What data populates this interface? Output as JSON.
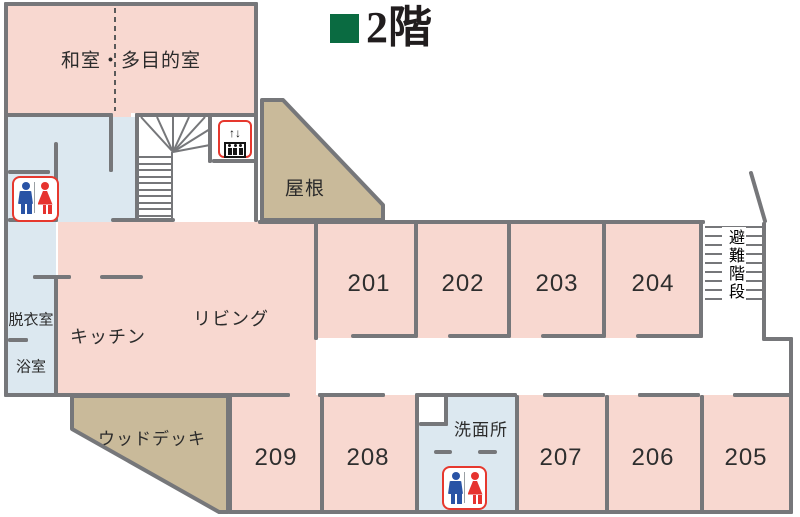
{
  "title": {
    "text": "2階"
  },
  "floor_labels": {
    "washitsu": "和室・多目的室",
    "roof": "屋根",
    "living": "リビング",
    "kitchen": "キッチン",
    "dressing_room": "脱衣室",
    "bathroom": "浴室",
    "wood_deck": "ウッドデッキ",
    "washroom": "洗面所",
    "emergency_stairs": "避難階段"
  },
  "rooms_top": [
    {
      "number": "201"
    },
    {
      "number": "202"
    },
    {
      "number": "203"
    },
    {
      "number": "204"
    }
  ],
  "rooms_bottom": [
    {
      "number": "209"
    },
    {
      "number": "208"
    },
    {
      "number": "207"
    },
    {
      "number": "206"
    },
    {
      "number": "205"
    }
  ],
  "elevator": {
    "up_arrow": "↑",
    "down_arrow": "↓"
  },
  "colors": {
    "room_pink": "#f8d8d0",
    "outdoor_tan": "#c9ba9a",
    "wet_area_blue": "#dce8f0",
    "wall_gray": "#76777a",
    "icon_border_red": "#e6382e",
    "man_blue": "#2953a5",
    "woman_red": "#e6332e",
    "title_green": "#0a6b41"
  }
}
